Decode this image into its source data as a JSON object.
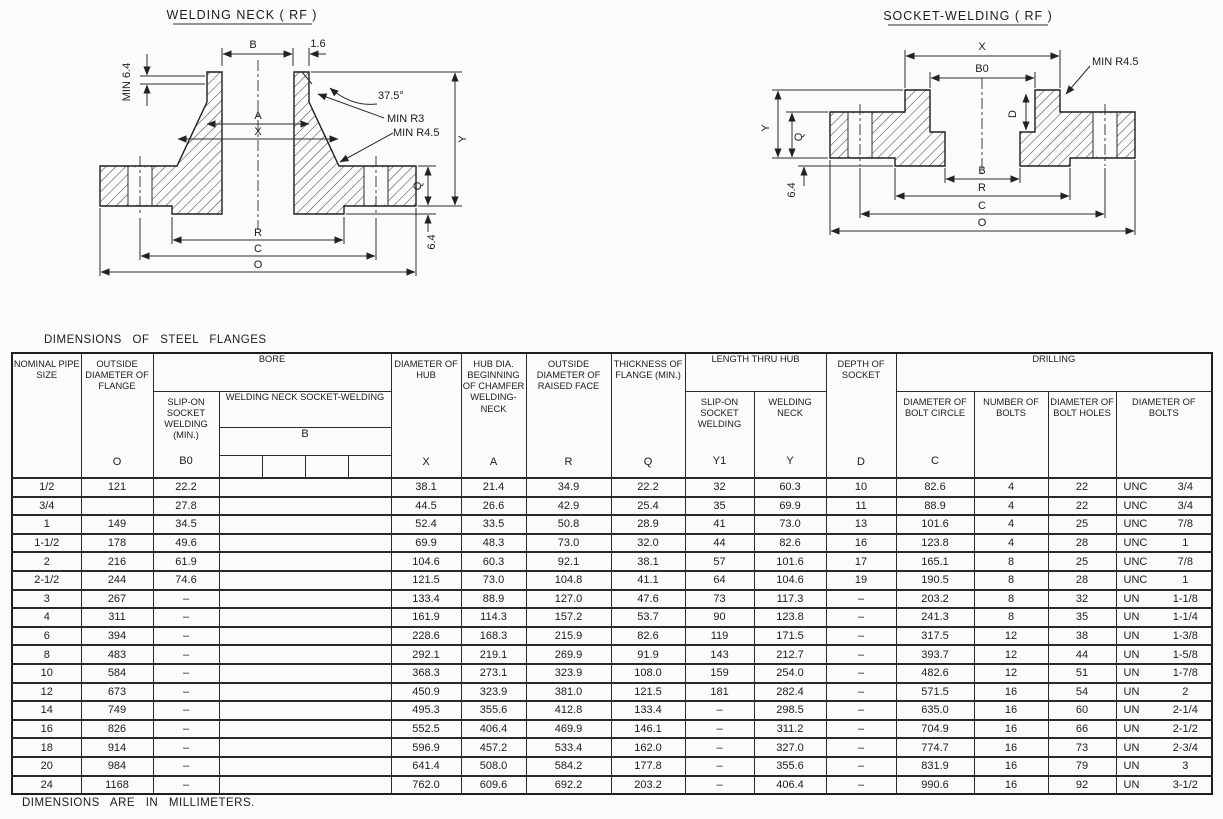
{
  "welding_neck_diagram": {
    "title": "WELDING NECK ( RF )",
    "labels": {
      "min_6_4": "MIN 6.4",
      "b": "B",
      "lip": "1.6",
      "angle": "37.5°",
      "min_r3": "MIN R3",
      "min_r45": "MIN R4.5",
      "a": "A",
      "x": "X",
      "y": "Y",
      "q": "Q",
      "rf_height": "6.4",
      "r": "R",
      "c": "C",
      "o": "O"
    }
  },
  "socket_welding_diagram": {
    "title": "SOCKET-WELDING ( RF )",
    "labels": {
      "x": "X",
      "b0": "B0",
      "min_r45": "MIN R4.5",
      "d": "D",
      "y": "Y",
      "q": "Q",
      "rf_height": "6.4",
      "b": "B",
      "r": "R",
      "c": "C",
      "o": "O"
    }
  },
  "table": {
    "title": "DIMENSIONS OF STEEL FLANGES",
    "footer": "DIMENSIONS ARE IN MILLIMETERS.",
    "headers": {
      "nominal": "NOMINAL PIPE SIZE",
      "outside": "OUTSIDE DIAMETER OF FLANGE",
      "outside_letter": "O",
      "bore": "BORE",
      "slip_on_min": "SLIP-ON SOCKET WELDING (MIN.)",
      "slip_on_min_letter": "B0",
      "welding_neck_sw": "WELDING NECK SOCKET-WELDING",
      "b_letter": "B",
      "dia_hub": "DIAMETER OF HUB",
      "dia_hub_letter": "X",
      "hub_dia": "HUB DIA. BEGINNING OF CHAMFER WELDING-NECK",
      "hub_dia_letter": "A",
      "raised_face": "OUTSIDE DIAMETER OF RAISED FACE",
      "raised_face_letter": "R",
      "thickness": "THICKNESS OF FLANGE (MIN.)",
      "thickness_letter": "Q",
      "length_thru_hub": "LENGTH THRU HUB",
      "slip_on_sw": "SLIP-ON SOCKET WELDING",
      "slip_on_sw_letter": "Y1",
      "welding_neck": "WELDING NECK",
      "welding_neck_letter": "Y",
      "depth_socket": "DEPTH OF SOCKET",
      "depth_socket_letter": "D",
      "drilling": "DRILLING",
      "bolt_circle": "DIAMETER OF BOLT CIRCLE",
      "bolt_circle_letter": "C",
      "num_bolts": "NUMBER OF BOLTS",
      "bolt_holes": "DIAMETER OF BOLT HOLES",
      "bolts_dia": "DIAMETER OF BOLTS"
    },
    "rows": [
      [
        "1/2",
        "121",
        "22.2",
        "",
        "38.1",
        "21.4",
        "34.9",
        "22.2",
        "32",
        "60.3",
        "10",
        "82.6",
        "4",
        "22",
        "UNC",
        "3/4"
      ],
      [
        "3/4",
        "",
        "27.8",
        "",
        "44.5",
        "26.6",
        "42.9",
        "25.4",
        "35",
        "69.9",
        "11",
        "88.9",
        "4",
        "22",
        "UNC",
        "3/4"
      ],
      [
        "1",
        "149",
        "34.5",
        "",
        "52.4",
        "33.5",
        "50.8",
        "28.9",
        "41",
        "73.0",
        "13",
        "101.6",
        "4",
        "25",
        "UNC",
        "7/8"
      ],
      [
        "1-1/2",
        "178",
        "49.6",
        "",
        "69.9",
        "48.3",
        "73.0",
        "32.0",
        "44",
        "82.6",
        "16",
        "123.8",
        "4",
        "28",
        "UNC",
        "1"
      ],
      [
        "2",
        "216",
        "61.9",
        "",
        "104.6",
        "60.3",
        "92.1",
        "38.1",
        "57",
        "101.6",
        "17",
        "165.1",
        "8",
        "25",
        "UNC",
        "7/8"
      ],
      [
        "2-1/2",
        "244",
        "74.6",
        "",
        "121.5",
        "73.0",
        "104.8",
        "41.1",
        "64",
        "104.6",
        "19",
        "190.5",
        "8",
        "28",
        "UNC",
        "1"
      ],
      [
        "3",
        "267",
        "–",
        "",
        "133.4",
        "88.9",
        "127.0",
        "47.6",
        "73",
        "117.3",
        "–",
        "203.2",
        "8",
        "32",
        "UN",
        "1-1/8"
      ],
      [
        "4",
        "311",
        "–",
        "",
        "161.9",
        "114.3",
        "157.2",
        "53.7",
        "90",
        "123.8",
        "–",
        "241.3",
        "8",
        "35",
        "UN",
        "1-1/4"
      ],
      [
        "6",
        "394",
        "–",
        "",
        "228.6",
        "168.3",
        "215.9",
        "82.6",
        "119",
        "171.5",
        "–",
        "317.5",
        "12",
        "38",
        "UN",
        "1-3/8"
      ],
      [
        "8",
        "483",
        "–",
        "",
        "292.1",
        "219.1",
        "269.9",
        "91.9",
        "143",
        "212.7",
        "–",
        "393.7",
        "12",
        "44",
        "UN",
        "1-5/8"
      ],
      [
        "10",
        "584",
        "–",
        "",
        "368.3",
        "273.1",
        "323.9",
        "108.0",
        "159",
        "254.0",
        "–",
        "482.6",
        "12",
        "51",
        "UN",
        "1-7/8"
      ],
      [
        "12",
        "673",
        "–",
        "",
        "450.9",
        "323.9",
        "381.0",
        "121.5",
        "181",
        "282.4",
        "–",
        "571.5",
        "16",
        "54",
        "UN",
        "2"
      ],
      [
        "14",
        "749",
        "–",
        "",
        "495.3",
        "355.6",
        "412.8",
        "133.4",
        "–",
        "298.5",
        "–",
        "635.0",
        "16",
        "60",
        "UN",
        "2-1/4"
      ],
      [
        "16",
        "826",
        "–",
        "",
        "552.5",
        "406.4",
        "469.9",
        "146.1",
        "–",
        "311.2",
        "–",
        "704.9",
        "16",
        "66",
        "UN",
        "2-1/2"
      ],
      [
        "18",
        "914",
        "–",
        "",
        "596.9",
        "457.2",
        "533.4",
        "162.0",
        "–",
        "327.0",
        "–",
        "774.7",
        "16",
        "73",
        "UN",
        "2-3/4"
      ],
      [
        "20",
        "984",
        "–",
        "",
        "641.4",
        "508.0",
        "584.2",
        "177.8",
        "–",
        "355.6",
        "–",
        "831.9",
        "16",
        "79",
        "UN",
        "3"
      ],
      [
        "24",
        "1168",
        "–",
        "",
        "762.0",
        "609.6",
        "692.2",
        "203.2",
        "–",
        "406.4",
        "–",
        "990.6",
        "16",
        "92",
        "UN",
        "3-1/2"
      ]
    ]
  }
}
